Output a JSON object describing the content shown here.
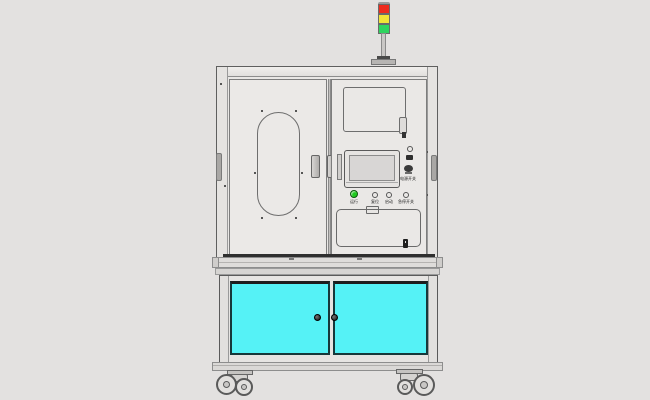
{
  "colors": {
    "bg": "#e3e1e0",
    "cyan": "#55f2f6",
    "lamp-red": "#ee2b1e",
    "lamp-yellow": "#f2e437",
    "lamp-green": "#2fd45f",
    "btn-green": "#1ecb1e"
  },
  "stack_light": {
    "segments": [
      "red",
      "yellow",
      "green"
    ]
  },
  "control_panel": {
    "power_label": "电源开关",
    "buttons": [
      {
        "label": "运行",
        "type": "green-push-button"
      },
      {
        "label": "复位",
        "type": "push-button"
      },
      {
        "label": "启动",
        "type": "push-button"
      },
      {
        "label": "急停开关",
        "type": "push-button"
      }
    ]
  },
  "lower_cabinet": {
    "door_color_name": "cyan",
    "doors": 2
  }
}
